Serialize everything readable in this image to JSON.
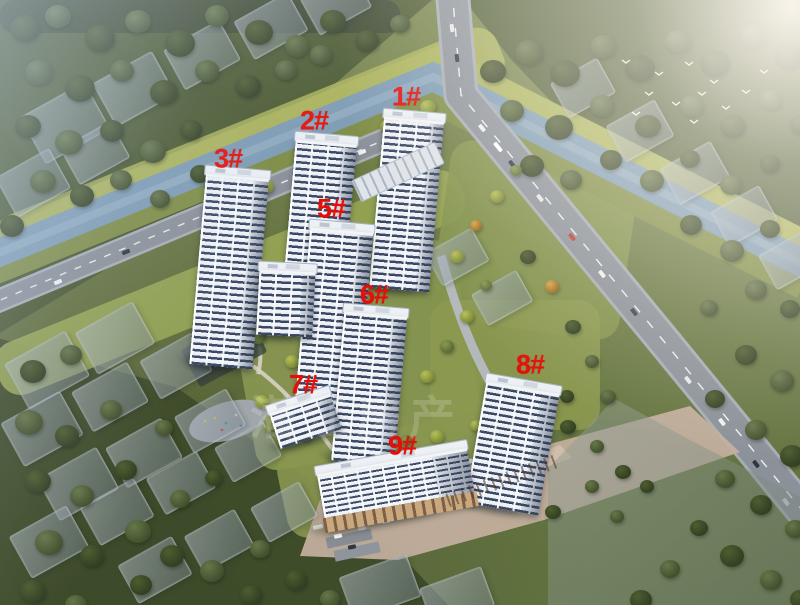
{
  "scene_title": "",
  "watermark": {
    "text": "潜江房产"
  },
  "labels": {
    "suffix": "#",
    "color": "#e90d06"
  },
  "buildings": [
    {
      "id": "1",
      "label": "1#",
      "type": "tower",
      "x": 377,
      "y": 110,
      "w": 60,
      "h": 180,
      "rot": 5,
      "lx": 406,
      "ly": 97
    },
    {
      "id": "2",
      "label": "2#",
      "type": "tower",
      "x": 288,
      "y": 133,
      "w": 61,
      "h": 195,
      "rot": 5,
      "lx": 314,
      "ly": 121
    },
    {
      "id": "3",
      "label": "3#",
      "type": "tower",
      "x": 198,
      "y": 167,
      "w": 63,
      "h": 200,
      "rot": 5,
      "lx": 228,
      "ly": 159
    },
    {
      "id": "5",
      "label": "5#",
      "type": "tower",
      "x": 302,
      "y": 221,
      "w": 63,
      "h": 205,
      "rot": 5,
      "lx": 331,
      "ly": 209
    },
    {
      "id": "mid",
      "label": "",
      "type": "tower",
      "x": 258,
      "y": 262,
      "w": 56,
      "h": 74,
      "rot": 3
    },
    {
      "id": "6",
      "label": "6#",
      "type": "tower",
      "x": 338,
      "y": 305,
      "w": 63,
      "h": 158,
      "rot": 5,
      "lx": 374,
      "ly": 295
    },
    {
      "id": "7",
      "label": "7#",
      "type": "tower",
      "x": 272,
      "y": 394,
      "w": 64,
      "h": 46,
      "rot": -18,
      "lx": 303,
      "ly": 385
    },
    {
      "id": "8",
      "label": "8#",
      "type": "tower",
      "x": 476,
      "y": 378,
      "w": 74,
      "h": 132,
      "rot": 10,
      "lx": 530,
      "ly": 365
    },
    {
      "id": "9",
      "label": "9#",
      "type": "slab",
      "x": 320,
      "y": 452,
      "w": 152,
      "h": 66,
      "rot": -10,
      "lx": 402,
      "ly": 446
    }
  ],
  "colors": {
    "river": "#7d9bb3",
    "road": "#8a9098",
    "label_red": "#e90d06",
    "tree_dark": "#47552e",
    "ghost": "#9aa4ae",
    "plaza": "#c2ae9d"
  }
}
